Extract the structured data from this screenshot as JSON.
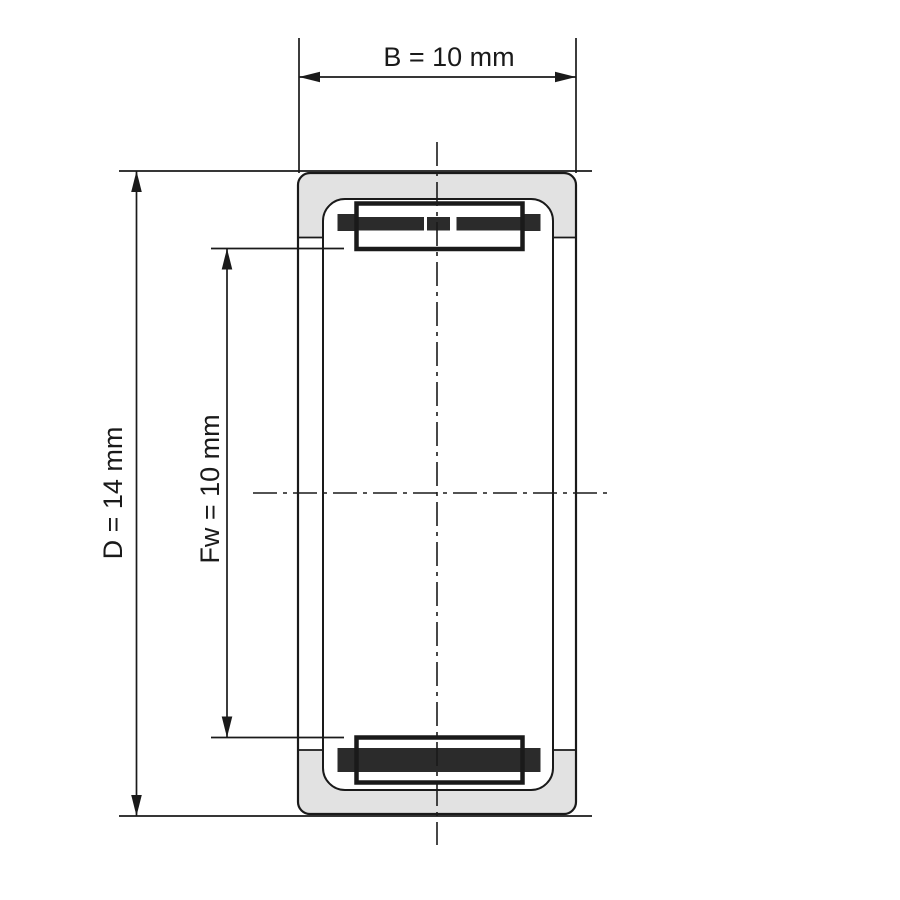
{
  "diagram": {
    "dimensions": [
      {
        "symbol": "B",
        "value": "10",
        "unit": "mm",
        "label": "B = 10 mm"
      },
      {
        "symbol": "D",
        "value": "14",
        "unit": "mm",
        "label": "D = 14 mm"
      },
      {
        "symbol": "Fw",
        "value": "10",
        "unit": "mm",
        "label": "Fw = 10 mm"
      }
    ],
    "colors": {
      "line": "#1a1a1a",
      "ring_fill": "#e2e2e2",
      "roller_fill": "#2b2b2b",
      "background": "#ffffff"
    }
  }
}
